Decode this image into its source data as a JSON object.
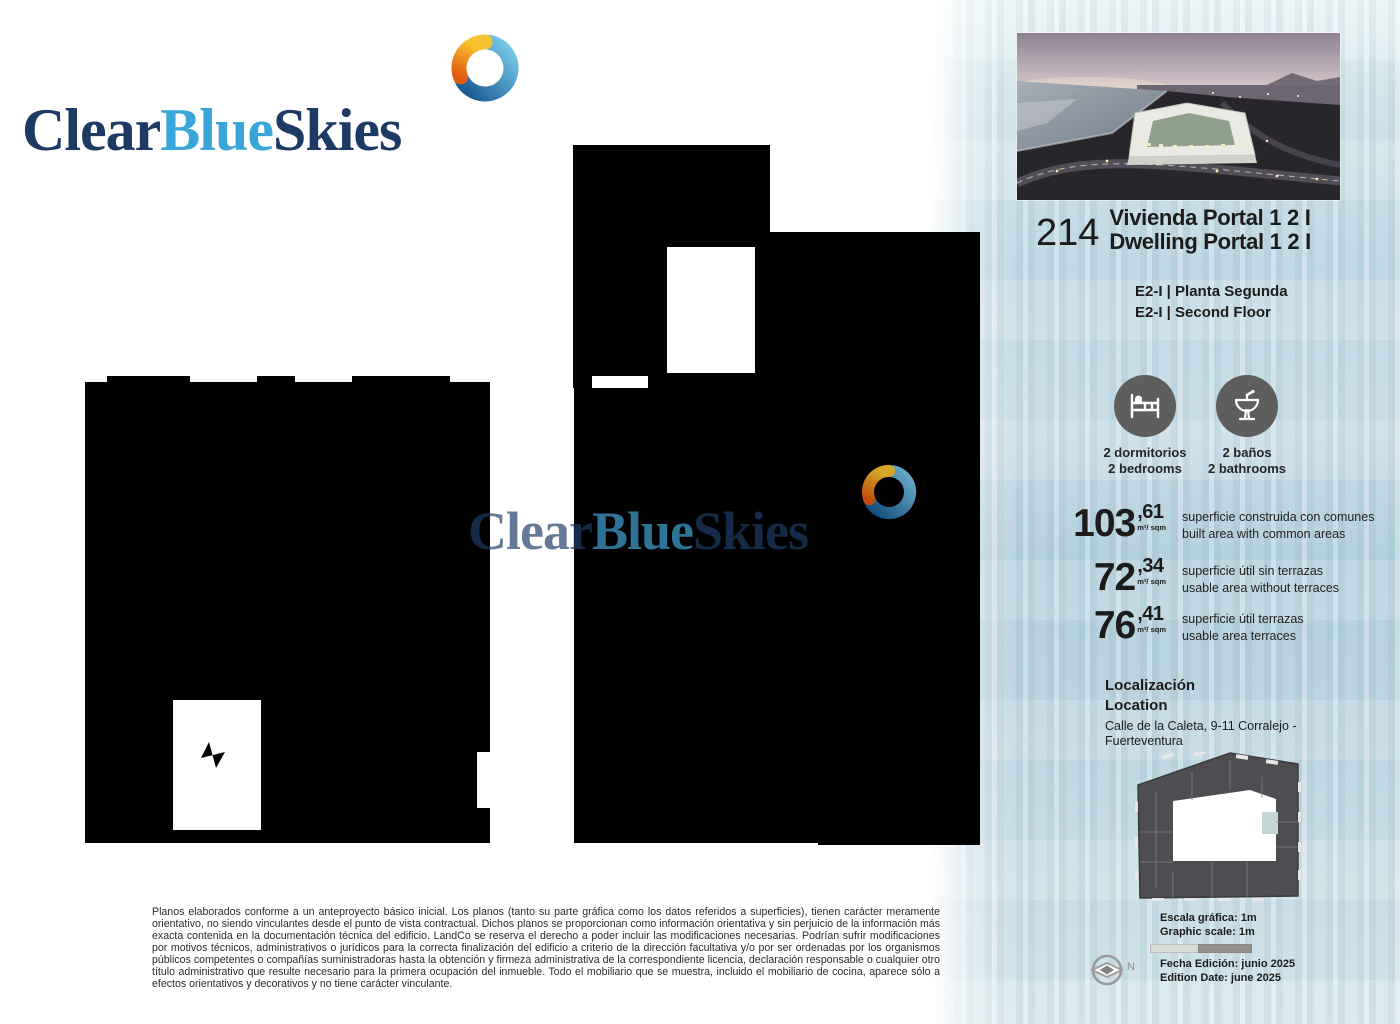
{
  "brand": {
    "clear": "Clear",
    "blue": "Blue",
    "skies": "Skies",
    "colors": {
      "navy": "#1c3a63",
      "light_blue": "#3aa5d8",
      "swirl_orange": "#ef8b12",
      "swirl_blue": "#1d6fae"
    }
  },
  "unit": {
    "number": "214",
    "title_es": "Vivienda Portal 1 2 I",
    "title_en": "Dwelling Portal 1 2 I",
    "floor_es": "E2-I | Planta Segunda",
    "floor_en": "E2-I | Second Floor"
  },
  "features": [
    {
      "icon": "bed-icon",
      "label_es": "2 dormitorios",
      "label_en": "2 bedrooms"
    },
    {
      "icon": "sink-icon",
      "label_es": "2 baños",
      "label_en": "2 bathrooms"
    }
  ],
  "areas": [
    {
      "int": "103",
      "dec": ",61",
      "unit": "m²/ sqm",
      "desc_es": "superficie construida con comunes",
      "desc_en": "built area with common areas"
    },
    {
      "int": "72",
      "dec": ",34",
      "unit": "m²/ sqm",
      "desc_es": "superficie útil sin terrazas",
      "desc_en": "usable area without terraces"
    },
    {
      "int": "76",
      "dec": ",41",
      "unit": "m²/ sqm",
      "desc_es": "superficie útil terrazas",
      "desc_en": "usable area terraces"
    }
  ],
  "location": {
    "label_es": "Localización",
    "label_en": "Location",
    "address": "Calle de la Caleta, 9-11 Corralejo - Fuerteventura"
  },
  "scale": {
    "label_es": "Escala gráfica: 1m",
    "label_en": "Graphic scale: 1m"
  },
  "north": {
    "label": "N"
  },
  "edition": {
    "label_es": "Fecha Edición: junio 2025",
    "label_en": "Edition Date: june 2025"
  },
  "disclaimer": "Planos elaborados conforme a un anteproyecto básico inicial. Los planos (tanto su parte gráfica como los datos referidos a superficies), tienen carácter meramente orientativo, no siendo vinculantes desde el punto de vista contractual. Dichos planos se proporcionan como información orientativa y sin perjuicio de la información más exacta contenida en la documentación técnica del edificio. LandCo se reserva el derecho a poder incluir las modificaciones necesarias. Podrían sufrir modificaciones por motivos técnicos, administrativos o jurídicos para la correcta finalización del edificio a criterio de la dirección facultativa y/o por ser ordenadas por los organismos públicos competentes o compañías suministradoras hasta la obtención y firmeza administrativa de la correspondiente licencia, declaración responsable o cualquier otro título administrativo que resulte necesario para la primera ocupación del inmueble. Todo el mobiliario que se muestra, incluido el mobiliario de cocina, aparece sólo a efectos orientativos y decorativos y no tiene carácter vinculante."
}
